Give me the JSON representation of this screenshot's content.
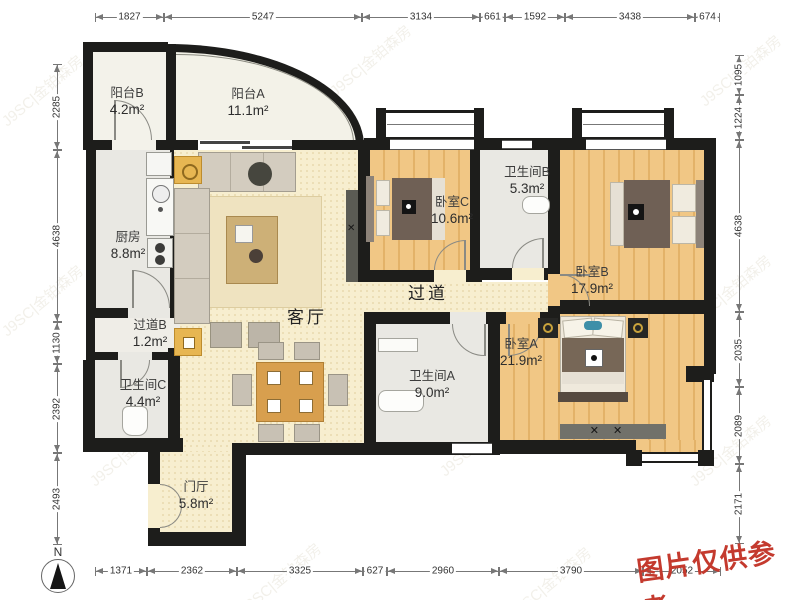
{
  "meta": {
    "disclaimer": "图片仅供参考",
    "watermark": "J9SC|金铂森房",
    "compass_label": "N"
  },
  "rooms": [
    {
      "id": "balcony_b",
      "name": "阳台B",
      "area": "4.2m²"
    },
    {
      "id": "balcony_a",
      "name": "阳台A",
      "area": "11.1m²"
    },
    {
      "id": "kitchen",
      "name": "厨房",
      "area": "8.8m²"
    },
    {
      "id": "living_room",
      "name": "客厅",
      "area": ""
    },
    {
      "id": "hallway_b",
      "name": "过道B",
      "area": "1.2m²"
    },
    {
      "id": "bath_c",
      "name": "卫生间C",
      "area": "4.4m²"
    },
    {
      "id": "foyer",
      "name": "门厅",
      "area": "5.8m²"
    },
    {
      "id": "bedroom_c",
      "name": "卧室C",
      "area": "10.6m²"
    },
    {
      "id": "bath_b",
      "name": "卫生间B",
      "area": "5.3m²"
    },
    {
      "id": "bedroom_b",
      "name": "卧室B",
      "area": "17.9m²"
    },
    {
      "id": "corridor",
      "name": "过道",
      "area": ""
    },
    {
      "id": "bedroom_a",
      "name": "卧室A",
      "area": "21.9m²"
    },
    {
      "id": "bath_a",
      "name": "卫生间A",
      "area": "9.0m²"
    }
  ],
  "dimensions": {
    "top": [
      1827,
      5247,
      3134,
      661,
      1592,
      3438,
      674
    ],
    "bottom": [
      1371,
      2362,
      3325,
      627,
      2960,
      3790,
      2052
    ],
    "left": [
      2285,
      4638,
      1130,
      2392,
      2493
    ],
    "right": [
      1095,
      1224,
      4638,
      2035,
      2089,
      2171
    ]
  }
}
